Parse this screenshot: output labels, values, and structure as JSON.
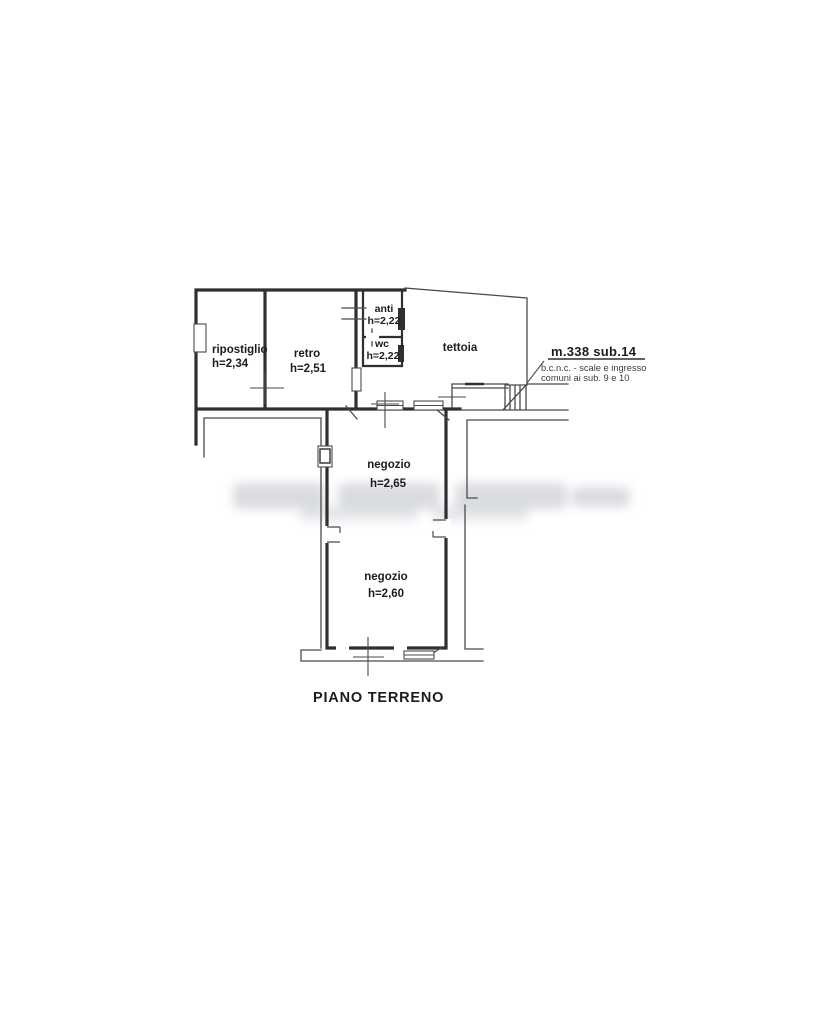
{
  "title": "PIANO TERRENO",
  "plan": {
    "floor_label": "PIANO TERRENO",
    "rooms": {
      "ripostiglio": {
        "name": "ripostiglio",
        "height": "h=2,34"
      },
      "retro": {
        "name": "retro",
        "height": "h=2,51"
      },
      "anti": {
        "name": "anti",
        "height": "h=2,22"
      },
      "wc": {
        "name": "wc",
        "height": "h=2,22"
      },
      "tettoia": {
        "name": "tettoia"
      },
      "negozio_1": {
        "name": "negozio",
        "height": "h=2,65"
      },
      "negozio_2": {
        "name": "negozio",
        "height": "h=2,60"
      }
    },
    "annotation": {
      "title": "m.338 sub.14",
      "description_line1": "b.c.n.c. - scale e ingresso",
      "description_line2": "comuni ai sub. 9 e 10"
    },
    "colors": {
      "background": "#ffffff",
      "wall_line": "#2f2f2f",
      "thin_line": "#4a4a4a",
      "text": "#1c1c1c"
    }
  }
}
